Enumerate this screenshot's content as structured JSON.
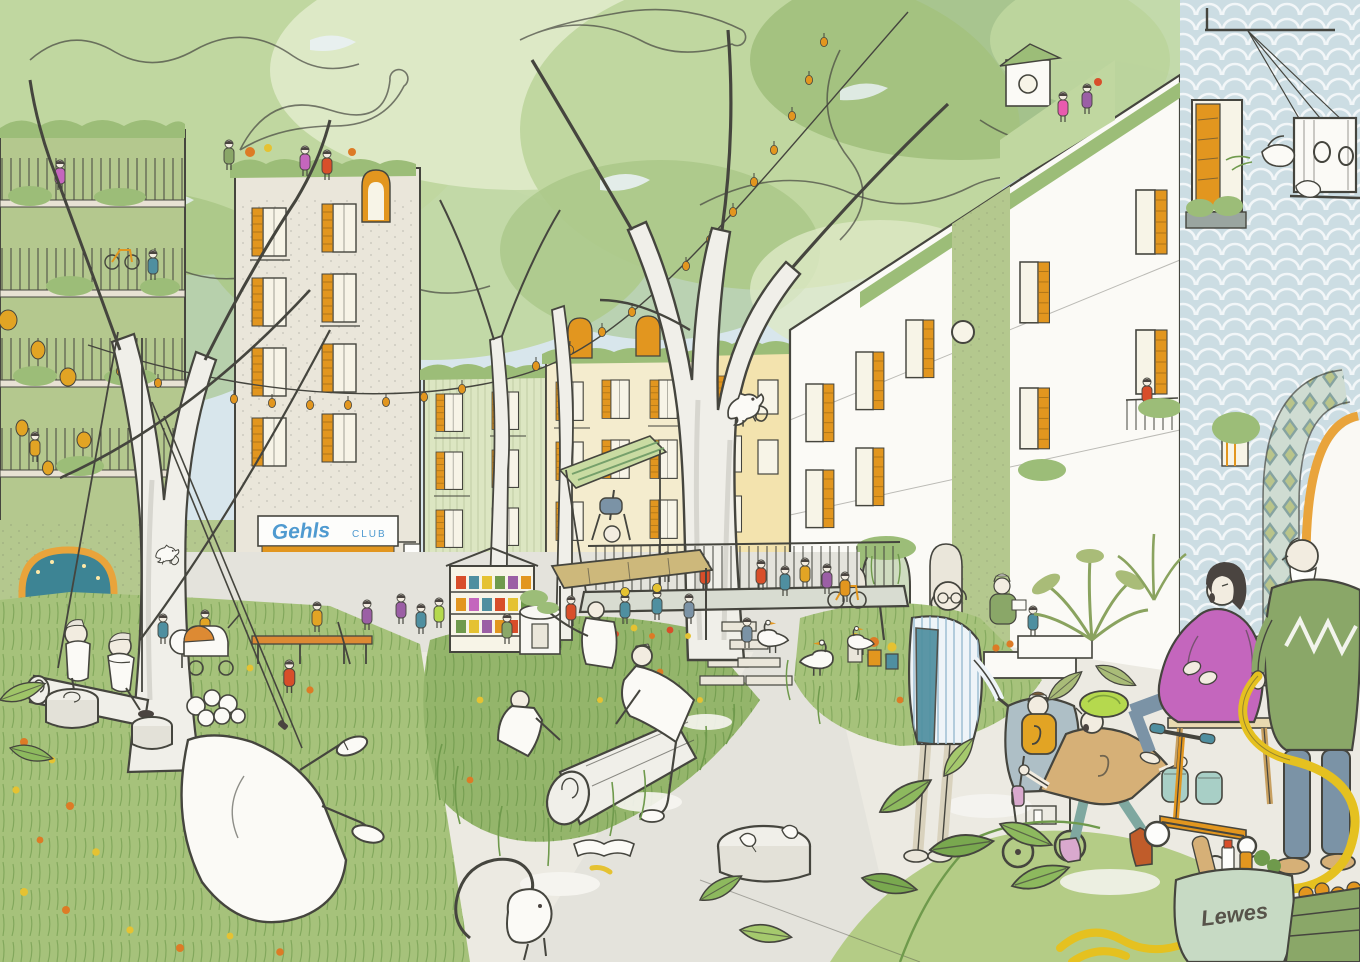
{
  "scene": {
    "type": "hand-drawn architectural concept illustration",
    "subject": "car-free green neighbourhood street shared by residents, children and wildlife",
    "texts": {
      "club_sign_script": "Gehls",
      "club_sign_caps": "CLUB",
      "tote_bag_label": "Lewes"
    },
    "palette": {
      "paper": "#fbfaf6",
      "line": "#45453e",
      "sky": "#d8e6ec",
      "sky_shadow": "#bccfd8",
      "canopy": "#c0d7a0",
      "canopy_light": "#dde9c6",
      "canopy_dark": "#9cbd78",
      "trunk": "#f0efe9",
      "trunk_shade": "#d7d6cf",
      "stone": "#eae6da",
      "cream": "#f4ecce",
      "yellow_wall": "#f3e3ae",
      "green_wall": "#b4c88e",
      "siding": "#dce6c2",
      "glass": "#f7f4e7",
      "platform": "#d8dcd1",
      "path": "#e4e3dc",
      "pavement": "#eceae2",
      "grass": "#a6c27b",
      "grass_dark": "#6f9a4c",
      "mound": "#94b56b",
      "flower_orange": "#dd7b26",
      "flower_yellow": "#e5c232",
      "shutter": "#e2961f",
      "bench_orange": "#dd8a33",
      "awning_tan": "#cdb87b",
      "red": "#d84e2a",
      "teal": "#4f8fa0",
      "denim": "#7b93a6",
      "mustard": "#e2a424",
      "lime": "#b5d94e",
      "magenta": "#c466bd",
      "pink": "#e85aae",
      "plum": "#9b5fa5",
      "green_sweater": "#8aa768",
      "hose": "#e5c120",
      "bag": "#c7dac4",
      "scale_wall": "#ccdde3",
      "arch_trim": "#e9a43b",
      "sign_blue": "#4f9ad0",
      "mural_teal": "#3d8494",
      "boot_rust": "#c05c2a",
      "boot_pink": "#d9a9ce",
      "boot_teal": "#a8cfc6"
    },
    "key_elements": [
      "tree-canopy",
      "string-lights",
      "paper-lanterns",
      "left-balcony-building",
      "gehls-club-storefront",
      "cafe-terrace",
      "rainbow-mural",
      "log-swing",
      "reclining-man",
      "log-movers",
      "tree-platform",
      "chameleons",
      "central-tree",
      "book-stall",
      "market-awning",
      "wildflower-meadow",
      "geese",
      "squirrel",
      "stroller-man",
      "child-in-stroller",
      "running-child",
      "pregnant-woman",
      "kick-scooter",
      "elderly-gardener",
      "garden-hose",
      "lewes-tote-bag",
      "fruit-crate",
      "birdhouse",
      "doves",
      "right-terrace-houses",
      "mosaic-archway",
      "roof-gardens",
      "raised-planters"
    ]
  }
}
